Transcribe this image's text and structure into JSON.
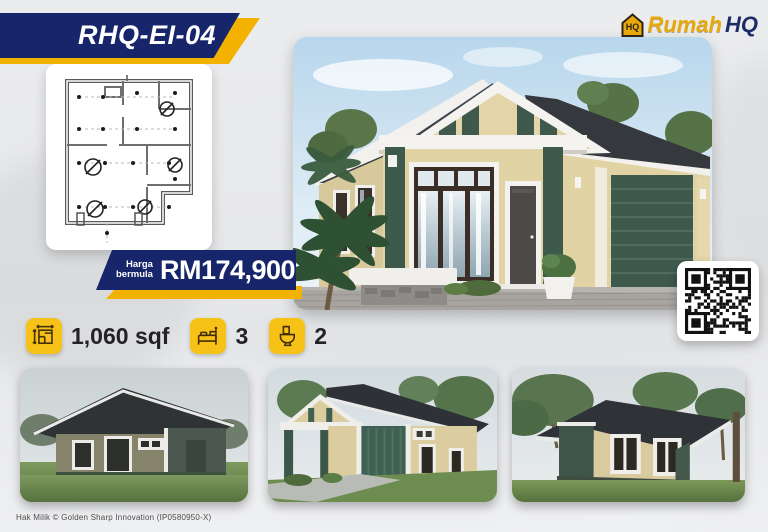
{
  "header": {
    "model_code": "RHQ-EI-04",
    "logo": {
      "brand_primary": "Rumah",
      "brand_secondary": "HQ",
      "icon": "house-logo-icon"
    }
  },
  "price": {
    "label_line1": "Harga",
    "label_line2": "bermula",
    "value": "RM174,900"
  },
  "specs": {
    "area": {
      "icon": "floor-plan-dimensions-icon",
      "value": "1,060 sqf"
    },
    "bedrooms": {
      "icon": "bed-icon",
      "value": "3"
    },
    "bathrooms": {
      "icon": "toilet-icon",
      "value": "2"
    }
  },
  "footer": {
    "copyright": "Hak Milik © Golden Sharp Innovation (IP0580950-X)"
  },
  "colors": {
    "navy": "#17266b",
    "gold": "#f3b200",
    "icon_yellow": "#f6c217",
    "roof_charcoal": "#35383c",
    "wall_cream": "#e2d3a5",
    "accent_green": "#3e5a4d"
  }
}
